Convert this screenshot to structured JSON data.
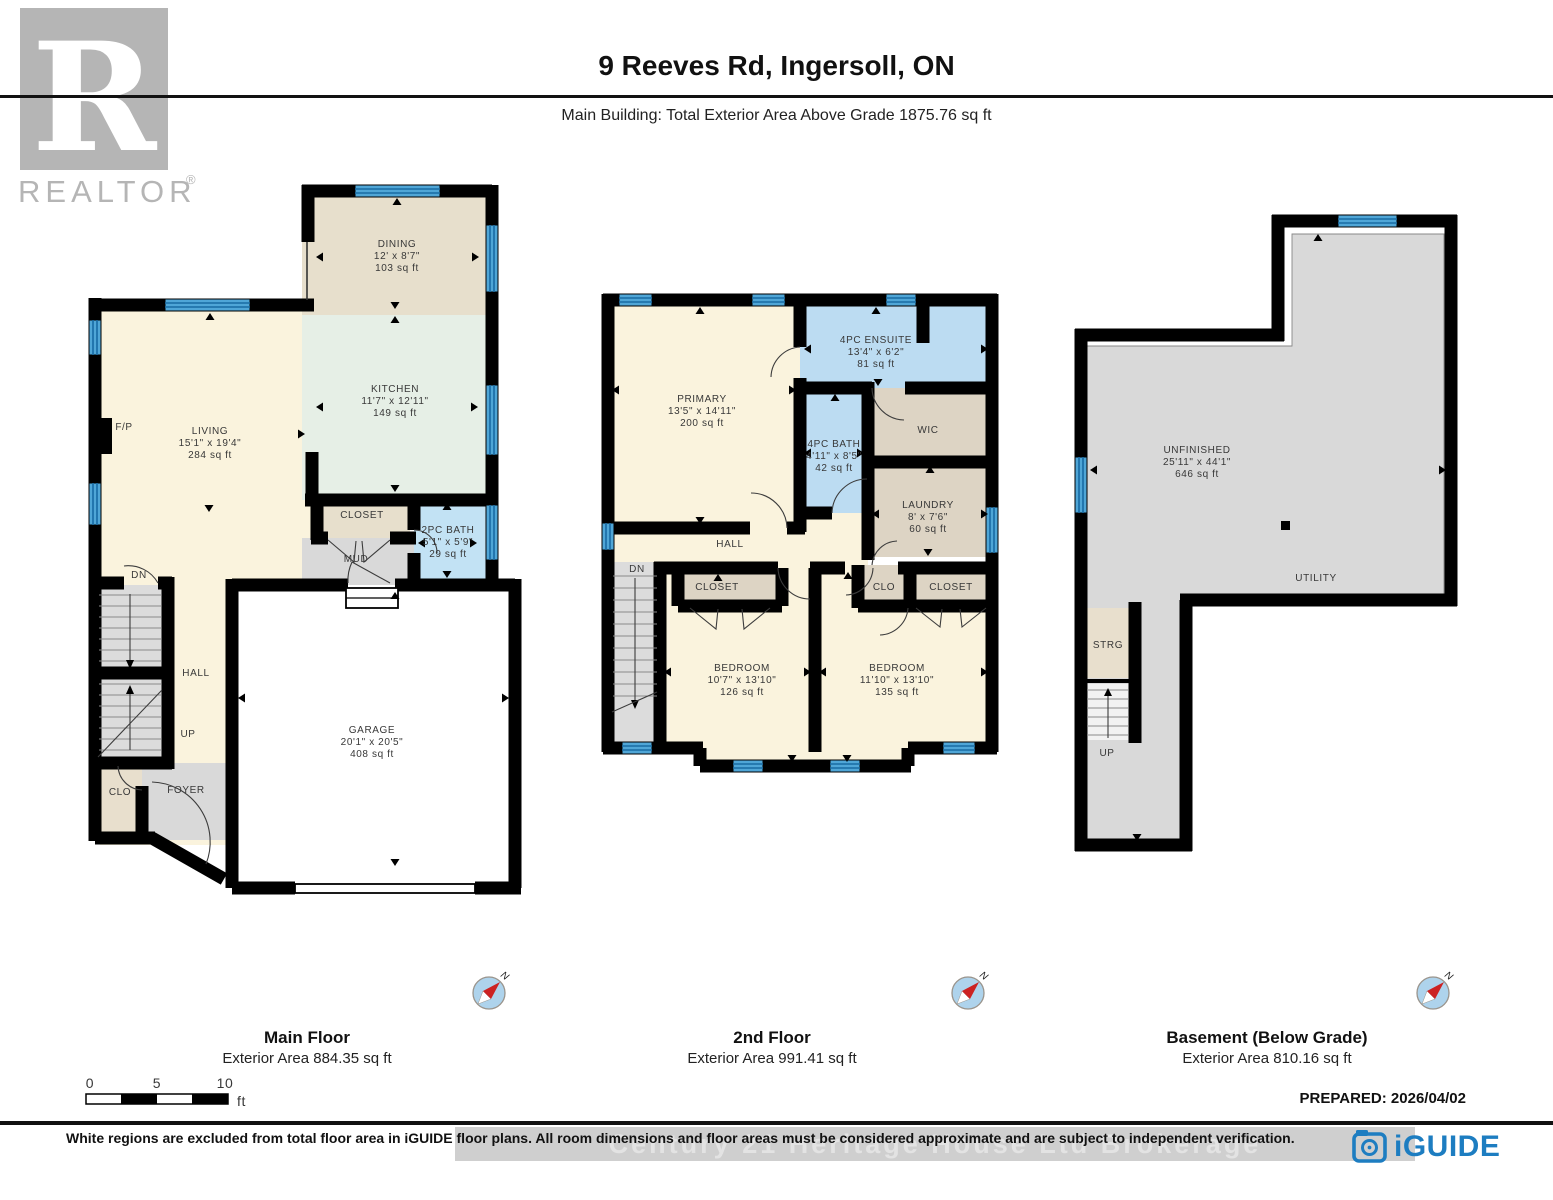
{
  "header": {
    "title": "9 Reeves Rd, Ingersoll, ON",
    "subtitle": "Main Building: Total Exterior Area Above Grade 1875.76 sq ft"
  },
  "branding": {
    "realtor_logo_letter": "R",
    "realtor_logo_text": "REALTOR",
    "registered_mark": "®",
    "iguide_logo_text": "iGUIDE"
  },
  "compass": {
    "north_label": "N"
  },
  "floors": {
    "main": {
      "title": "Main Floor",
      "area_label": "Exterior Area 884.35 sq ft",
      "rooms": {
        "dining": {
          "name": "DINING",
          "dims": "12' x 8'7\"",
          "area": "103 sq ft"
        },
        "kitchen": {
          "name": "KITCHEN",
          "dims": "11'7\" x 12'11\"",
          "area": "149 sq ft"
        },
        "living": {
          "name": "LIVING",
          "dims": "15'1\" x 19'4\"",
          "area": "284 sq ft"
        },
        "bath2pc": {
          "name": "2PC BATH",
          "dims": "5'1\" x 5'9\"",
          "area": "29 sq ft"
        },
        "garage": {
          "name": "GARAGE",
          "dims": "20'1\" x 20'5\"",
          "area": "408 sq ft"
        },
        "closet": {
          "name": "CLOSET"
        },
        "mud": {
          "name": "MUD"
        },
        "hall": {
          "name": "HALL"
        },
        "foyer": {
          "name": "FOYER"
        },
        "clo": {
          "name": "CLO"
        },
        "fireplace": {
          "name": "F/P"
        },
        "dn": {
          "name": "DN"
        },
        "up": {
          "name": "UP"
        }
      }
    },
    "second": {
      "title": "2nd Floor",
      "area_label": "Exterior Area 991.41 sq ft",
      "rooms": {
        "primary": {
          "name": "PRIMARY",
          "dims": "13'5\" x 14'11\"",
          "area": "200 sq ft"
        },
        "ensuite": {
          "name": "4PC ENSUITE",
          "dims": "13'4\" x 6'2\"",
          "area": "81 sq ft"
        },
        "bath4pc": {
          "name": "4PC BATH",
          "dims": "4'11\" x 8'5\"",
          "area": "42 sq ft"
        },
        "wic": {
          "name": "WIC"
        },
        "laundry": {
          "name": "LAUNDRY",
          "dims": "8' x 7'6\"",
          "area": "60 sq ft"
        },
        "hall": {
          "name": "HALL"
        },
        "dn": {
          "name": "DN"
        },
        "closet1": {
          "name": "CLOSET"
        },
        "clo": {
          "name": "CLO"
        },
        "closet2": {
          "name": "CLOSET"
        },
        "bedroom1": {
          "name": "BEDROOM",
          "dims": "10'7\" x 13'10\"",
          "area": "126 sq ft"
        },
        "bedroom2": {
          "name": "BEDROOM",
          "dims": "11'10\" x 13'10\"",
          "area": "135 sq ft"
        }
      }
    },
    "basement": {
      "title": "Basement (Below Grade)",
      "area_label": "Exterior Area 810.16 sq ft",
      "rooms": {
        "unfinished": {
          "name": "UNFINISHED",
          "dims": "25'11\" x 44'1\"",
          "area": "646 sq ft"
        },
        "utility": {
          "name": "UTILITY"
        },
        "strg": {
          "name": "STRG"
        },
        "up": {
          "name": "UP"
        }
      }
    }
  },
  "scale_bar": {
    "t0": "0",
    "t5": "5",
    "t10": "10",
    "unit": "ft"
  },
  "footer": {
    "prepared": "PREPARED: 2026/04/02",
    "disclaimer": "White regions are excluded from total floor area in iGUIDE floor plans. All room dimensions and floor areas must be considered approximate and are subject to independent verification.",
    "watermark": "Century 21 Heritage House Ltd Brokerage"
  }
}
